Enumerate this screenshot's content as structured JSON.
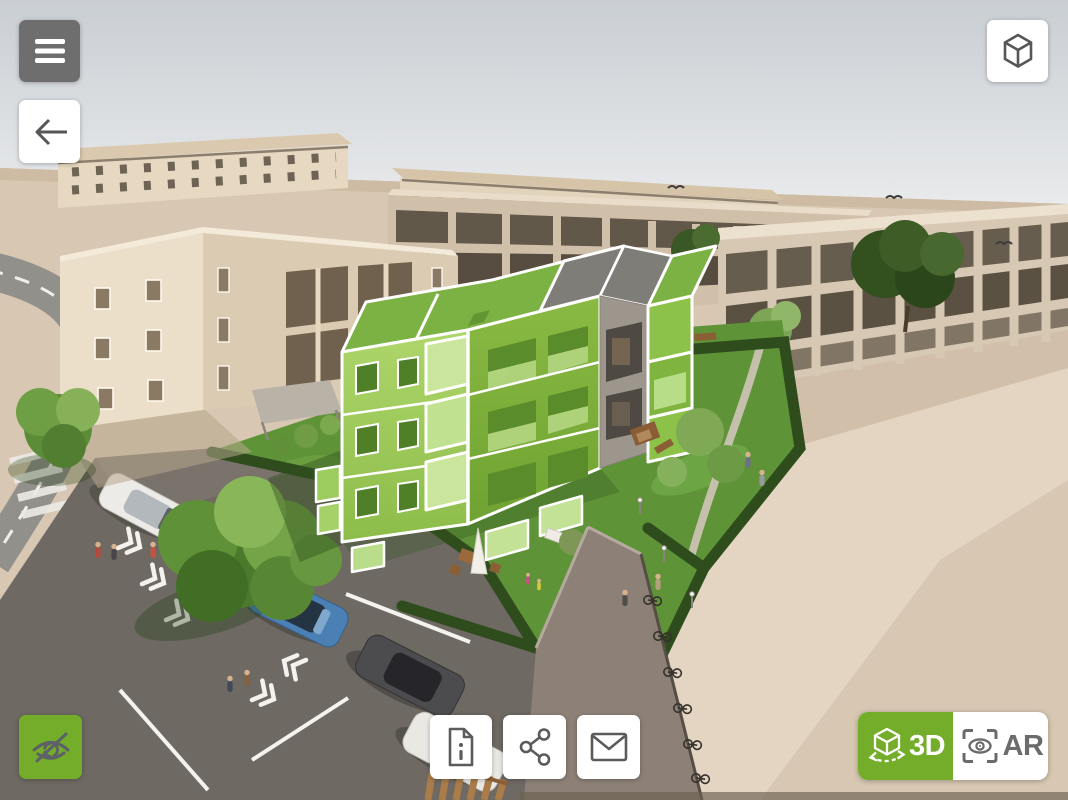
{
  "view": {
    "type": "3d-building-viewer",
    "scene": "Aerial 3D rendering of an apartment complex; center building highlighted in green, surrounded by beige buildings, lawns, a parking lot with cars and a road"
  },
  "colors": {
    "accent_green": "#74ad29",
    "highlight_building_green": "#8abd45",
    "menu_button_gray": "#6e6e6e",
    "icon_gray": "#5b5b5b",
    "button_white": "#ffffff"
  },
  "top_bar": {
    "menu_button": {
      "icon": "hamburger-icon"
    },
    "back_button": {
      "icon": "arrow-left-icon"
    },
    "model_button": {
      "icon": "cube-icon"
    }
  },
  "bottom_bar": {
    "visibility_button": {
      "icon": "eye-slash-icon",
      "active": true
    },
    "info_button": {
      "icon": "info-document-icon"
    },
    "share_button": {
      "icon": "share-icon"
    },
    "contact_button": {
      "icon": "mail-icon"
    },
    "view_mode_switch": {
      "options": [
        {
          "label": "3D",
          "icon": "cube-rotate-icon",
          "active": true
        },
        {
          "label": "AR",
          "icon": "ar-eye-icon",
          "active": false
        }
      ]
    }
  }
}
